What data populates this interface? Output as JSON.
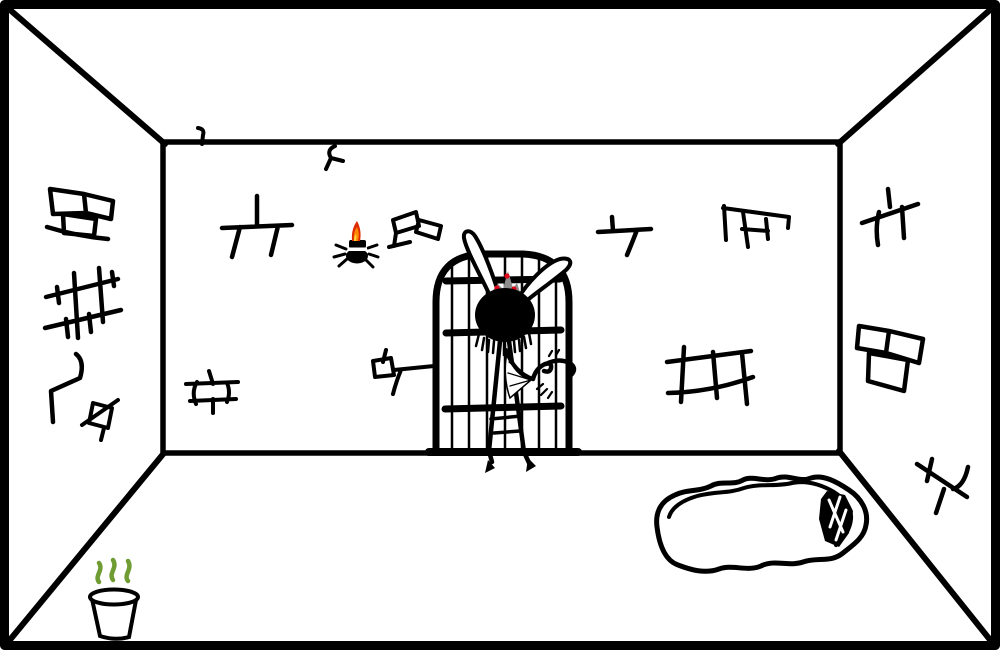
{
  "scene": {
    "name": "hand-drawn-dungeon-cell-room",
    "background": "#ffffff",
    "ink": "#000000",
    "colors": {
      "flame_outer": "#dd2b00",
      "flame_mid": "#ff8a00",
      "flame_core": "#ffd83d",
      "stink_green": "#6f9c33",
      "crown_gray": "#8d8d8d",
      "jewel_red": "#e00718"
    },
    "objects": [
      {
        "name": "room-perspective-box",
        "interactable": false
      },
      {
        "name": "barred-door",
        "interactable": true
      },
      {
        "name": "rabbit-eared-creature",
        "interactable": true
      },
      {
        "name": "spider-with-candle",
        "interactable": true
      },
      {
        "name": "stinky-bucket",
        "interactable": true
      },
      {
        "name": "floor-rug-hole",
        "interactable": true
      },
      {
        "name": "wall-brick-and-crack-marks",
        "interactable": false
      }
    ]
  }
}
